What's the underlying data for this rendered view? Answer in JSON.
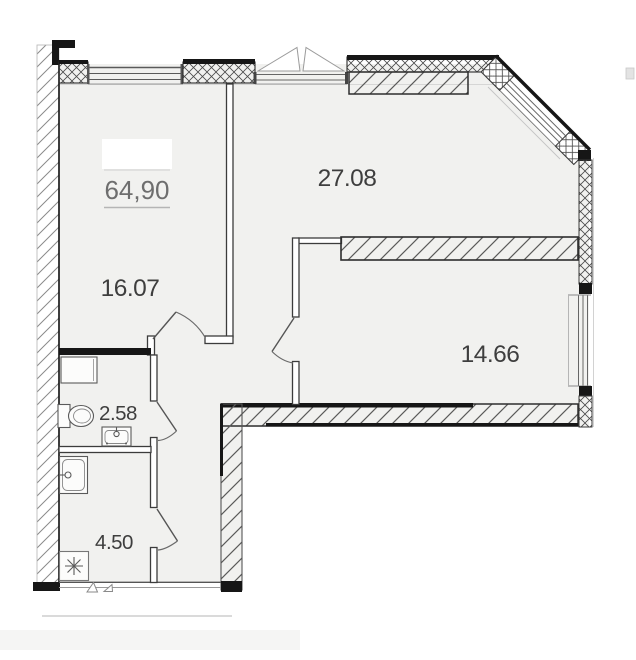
{
  "plan": {
    "type": "apartment-floor-plan",
    "total_area": "64,90",
    "room_areas": {
      "living": "27.08",
      "bedroom": "16.07",
      "room_right": "14.66",
      "bathroom": "2.58",
      "kitchen_niche": "4.50"
    },
    "fixture_icons": [
      "toilet-icon",
      "bathroom-sink-icon",
      "shower-tray-icon",
      "kitchen-washbasin-icon",
      "refrigerator-snowflake-icon",
      "window-opening-triangles-icon"
    ],
    "colors": {
      "floor": "#f1f1ef",
      "wall_black": "#161616",
      "wall_line": "#3c3c3c",
      "hatch": "#8a8a8a",
      "label_dark": "#3e3e3e",
      "label_gray": "#6e6e6e"
    }
  }
}
